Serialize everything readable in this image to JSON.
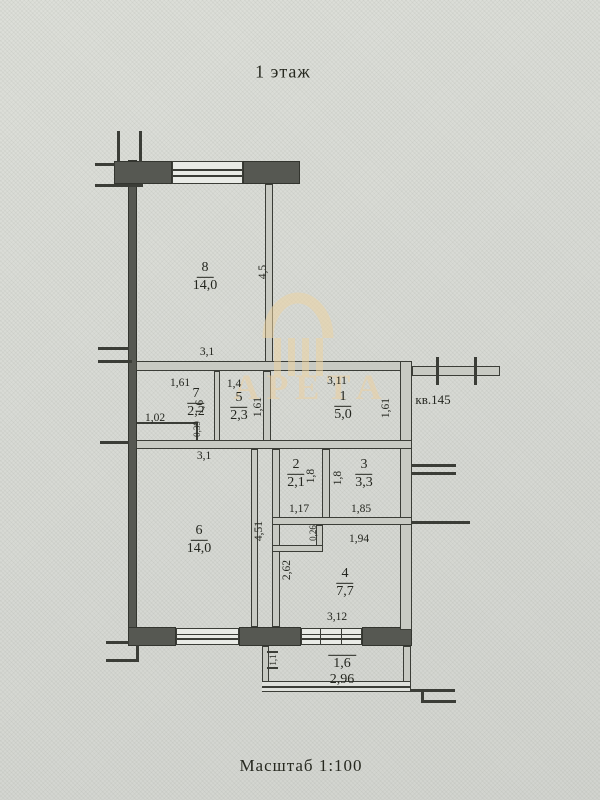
{
  "title": "1 этаж",
  "scale_caption": "Масштаб 1:100",
  "apartment_ref": "кв.145",
  "watermark": "АРЕТА",
  "rooms": {
    "r8": {
      "num": "8",
      "area": "14,0"
    },
    "r7": {
      "num": "7",
      "area": "2,2"
    },
    "r5": {
      "num": "5",
      "area": "2,3"
    },
    "r1": {
      "num": "1",
      "area": "5,0"
    },
    "r2": {
      "num": "2",
      "area": "2,1"
    },
    "r3": {
      "num": "3",
      "area": "3,3"
    },
    "r6": {
      "num": "6",
      "area": "14,0"
    },
    "r4": {
      "num": "4",
      "area": "7,7"
    },
    "balcony": {
      "num": "1,6",
      "area": "2,96"
    }
  },
  "dims": {
    "room8_width": "3,1",
    "room8_height": "4,5",
    "room7_width": "1,61",
    "room7_height": "1,6",
    "room7_closet_width": "1,02",
    "room7_closet_depth": "0,39",
    "room5_width": "1,4",
    "room5_height": "1,61",
    "hall_width": "3,11",
    "hall_height": "1,61",
    "room6_width": "3,1",
    "room6_height": "4,51",
    "room2_width": "1,17",
    "room2_height": "1,8",
    "room3_width": "1,85",
    "room3_height": "1,8",
    "room4_left_height": "2,62",
    "niche_width": "1,94",
    "niche_depth": "0,26",
    "room4_width": "3,12",
    "balcony_depth": "1,1"
  }
}
